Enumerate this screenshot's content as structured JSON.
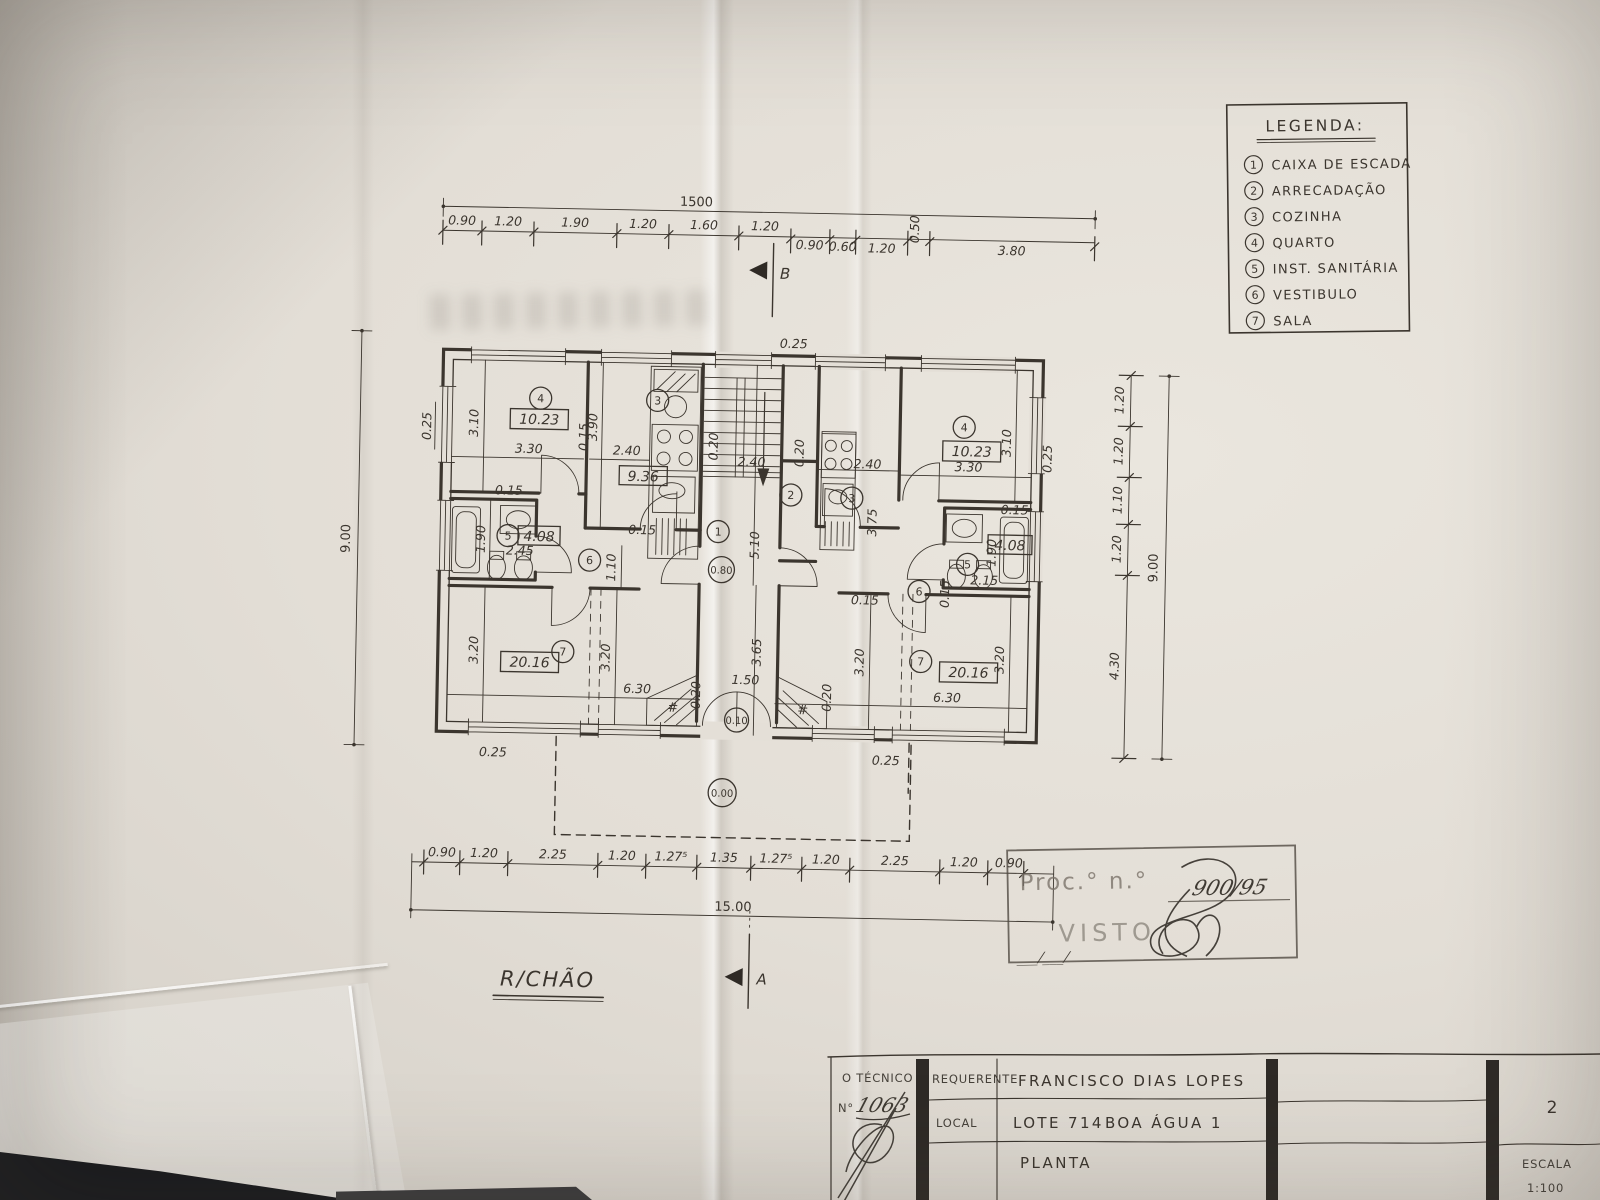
{
  "photo": {
    "floor_label": "R/CHÃO"
  },
  "legend": {
    "title": "LEGENDA:",
    "items": [
      {
        "num": "1",
        "label": "CAIXA DE ESCADA"
      },
      {
        "num": "2",
        "label": "ARRECADAÇÃO"
      },
      {
        "num": "3",
        "label": "COZINHA"
      },
      {
        "num": "4",
        "label": "QUARTO"
      },
      {
        "num": "5",
        "label": "INST. SANITÁRIA"
      },
      {
        "num": "6",
        "label": "VESTIBULO"
      },
      {
        "num": "7",
        "label": "SALA"
      }
    ]
  },
  "dims": {
    "top": {
      "total": "1500",
      "segments": [
        "0.90",
        "1.20",
        "1.90",
        "1.20",
        "1.60",
        "1.20",
        "0.90",
        "0.60",
        "1.20",
        "0.50",
        "3.80"
      ]
    },
    "bottom": {
      "total": "15.00",
      "segments": [
        "0.90",
        "1.20",
        "2.25",
        "1.20",
        "1.27⁵",
        "1.35",
        "1.27⁵",
        "1.20",
        "2.25",
        "1.20",
        "0.90"
      ]
    },
    "left": {
      "total": "9.00",
      "wall": "0.25"
    },
    "right": {
      "total": "9.00",
      "segments": [
        "1.20",
        "1.20",
        "1.10",
        "1.20",
        "4.30"
      ]
    }
  },
  "sections": {
    "a": "A",
    "b": "B"
  },
  "plan": {
    "stair": {
      "num": "1",
      "depth": "5.10",
      "width": "2.40",
      "tread": "0.20",
      "landing_level": "0.80",
      "hall_depth": "3.65"
    },
    "storage": {
      "num": "2"
    },
    "entry": {
      "width": "1.50",
      "step_level": "0.10",
      "ground_level": "0.00",
      "side": "0.20",
      "hatch": "#"
    },
    "walls": {
      "ext": "0.25",
      "int": "0.15"
    },
    "left": {
      "bedroom": {
        "num": "4",
        "area": "10.23",
        "w": "3.30",
        "h": "3.10"
      },
      "kitchen": {
        "num": "3",
        "area": "9.36",
        "w": "2.40",
        "h": "3.90"
      },
      "bath": {
        "num": "5",
        "area": "4.08",
        "h": "1.90",
        "w": "2.45"
      },
      "hall": {
        "num": "6",
        "d": "1.10"
      },
      "living": {
        "num": "7",
        "area": "20.16",
        "w": "6.30",
        "h": "3.20"
      }
    },
    "right": {
      "bedroom": {
        "num": "4",
        "area": "10.23",
        "w": "3.30",
        "h": "3.10"
      },
      "kitchen": {
        "num": "3",
        "w": "2.40",
        "h": "3.75"
      },
      "bath": {
        "num": "5",
        "area": "4.08",
        "h": "1.90",
        "w": "2.15"
      },
      "hall": {
        "num": "6"
      },
      "living": {
        "num": "7",
        "area": "20.16",
        "w": "6.30",
        "h": "3.20"
      }
    }
  },
  "stamp": {
    "proc_label": "Proc.° n.°",
    "proc_no": "900/95",
    "visto": "VISTO",
    "date": "___/___/"
  },
  "titleblock": {
    "technician_label": "O TÉCNICO",
    "technician_no_label": "N°",
    "technician_no": "1063",
    "requester_label": "REQUERENTE",
    "requester_value": "FRANCISCO DIAS LOPES",
    "local_label": "LOCAL",
    "local_value": "LOTE 714",
    "local_value2": "BOA ÁGUA 1",
    "drawing_type": "PLANTA",
    "sheet_no": "2",
    "scale_label": "ESCALA",
    "scale_value": "1:100"
  }
}
